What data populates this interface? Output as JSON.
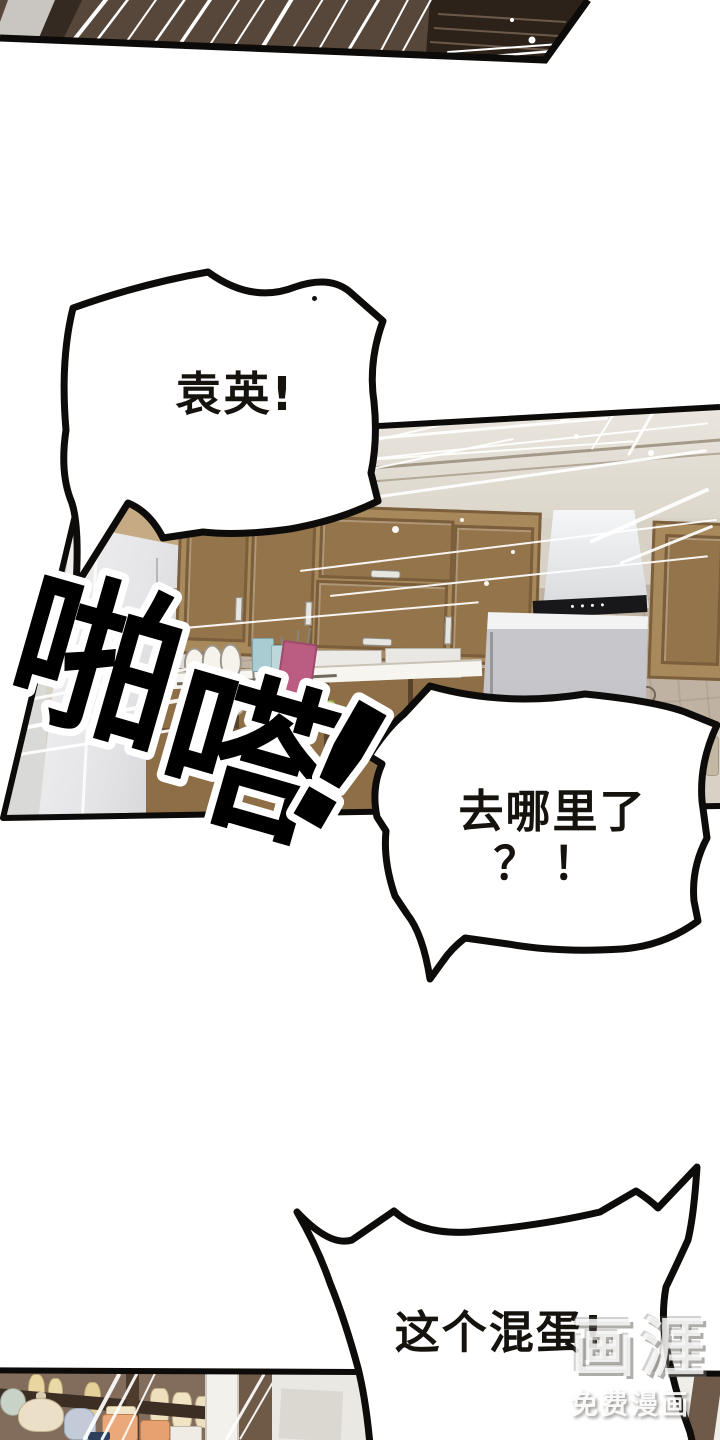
{
  "comic": {
    "bubble1": {
      "text": "袁英!"
    },
    "bubble2": {
      "line1": "去哪里了",
      "line2": "？！"
    },
    "bubble3": {
      "text": "这个混蛋!"
    },
    "sfx": {
      "c1": "啪",
      "c2": "嗒",
      "c3": "!"
    },
    "watermark": {
      "logo": "画涯",
      "caption": "免费漫画"
    },
    "colors": {
      "wood": "#a8895c",
      "dark_panel": "#56473a",
      "pink_board": "#bb5d82",
      "outline": "#0d0b09"
    }
  }
}
